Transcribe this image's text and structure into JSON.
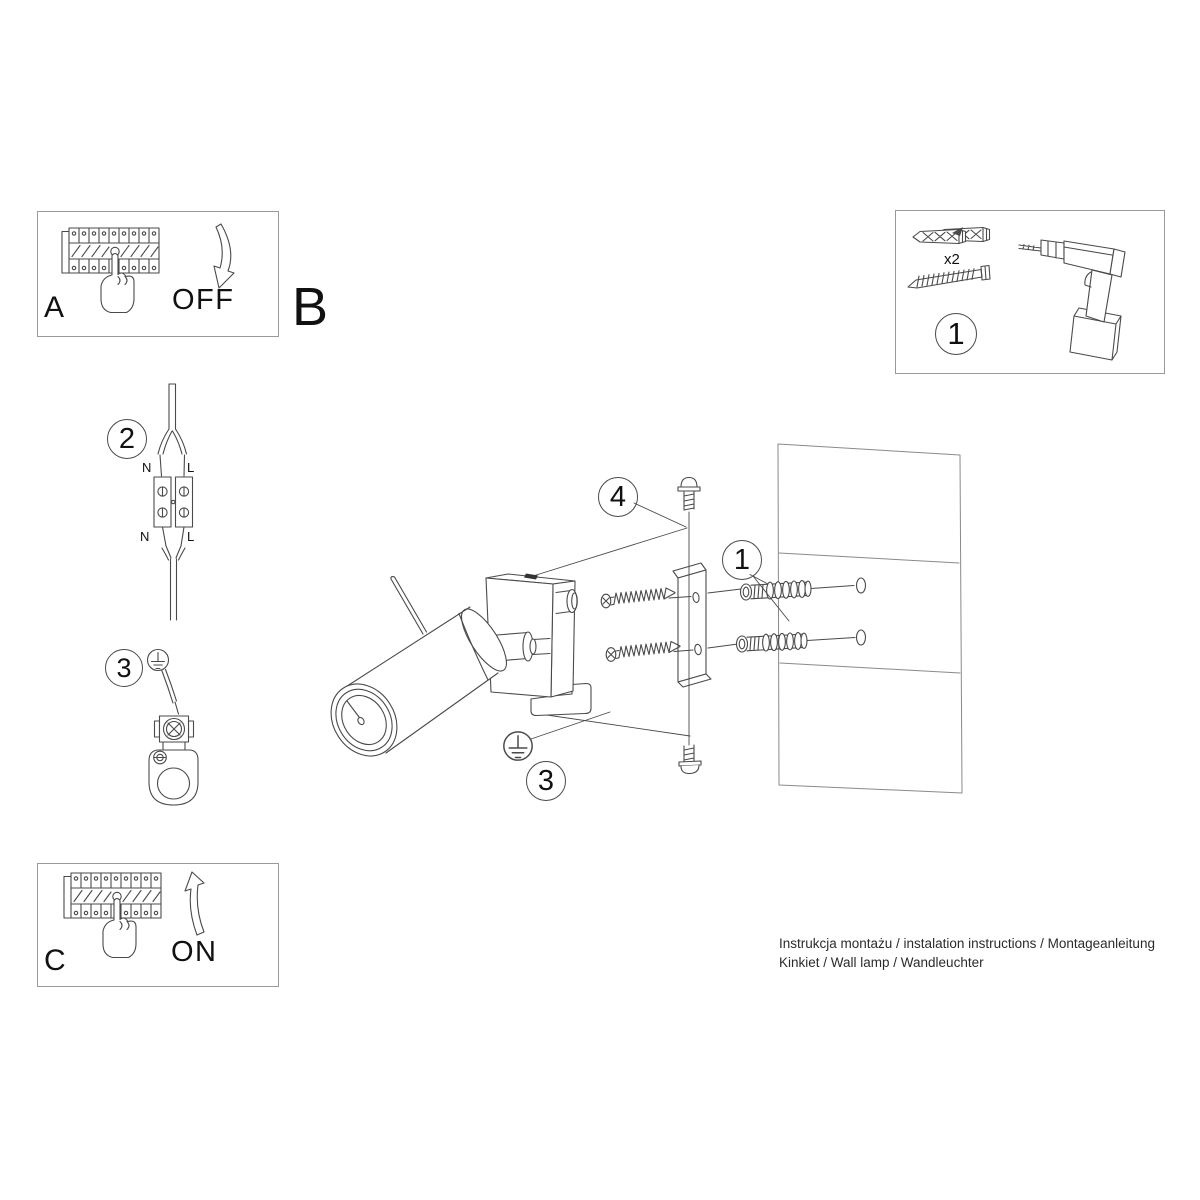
{
  "colors": {
    "line": "#4a4a4a",
    "border": "#9a9a9a",
    "background": "#ffffff",
    "text": "#111111"
  },
  "steps": {
    "a": {
      "label": "A",
      "action": "OFF"
    },
    "b": {
      "label": "B"
    },
    "c": {
      "label": "C",
      "action": "ON"
    }
  },
  "kit": {
    "callout": "1",
    "quantity": "x2"
  },
  "callouts": {
    "terminal_block": "2",
    "ground_detail": "3",
    "set_screw": "4",
    "wall_anchors": "1",
    "ground_main": "3"
  },
  "wire_labels": {
    "top_n": "N",
    "top_l": "L",
    "bottom_n": "N",
    "bottom_l": "L"
  },
  "footer": {
    "line1": "Instrukcja montażu / instalation instructions / Montageanleitung",
    "line2": "Kinkiet / Wall lamp / Wandleuchter"
  }
}
